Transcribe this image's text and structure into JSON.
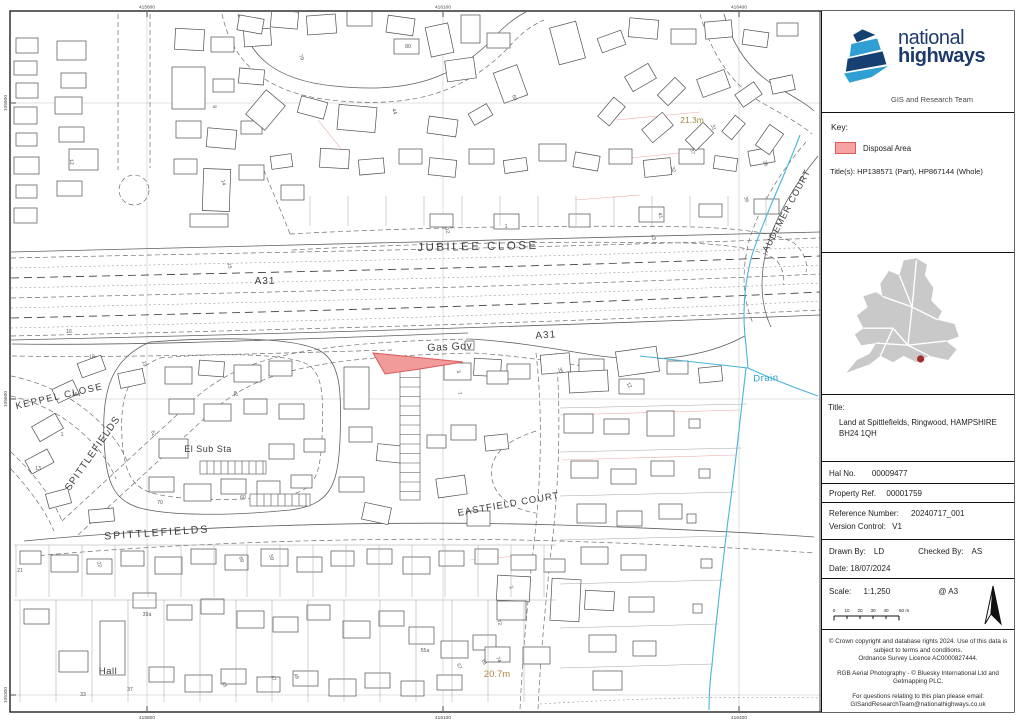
{
  "logo": {
    "line1": "national",
    "line2": "highways",
    "team": "GIS and Research Team"
  },
  "key": {
    "heading": "Key:",
    "disposal_label": "Disposal Area",
    "titles": "Title(s): HP138571 (Part), HP867144 (Whole)"
  },
  "title_block": {
    "label": "Title:",
    "line1": "Land at Spittlefields, Ringwood, HAMPSHIRE",
    "line2": "BH24 1QH"
  },
  "fields": {
    "hal_label": "Hal No.",
    "hal_value": "00009477",
    "property_label": "Property Ref.",
    "property_value": "00001759",
    "reference_label": "Reference Number:",
    "reference_value": "20240717_001",
    "version_label": "Version Control:",
    "version_value": "V1",
    "drawn_label": "Drawn By:",
    "drawn_value": "LD",
    "checked_label": "Checked By:",
    "checked_value": "AS",
    "date_label": "Date:",
    "date_value": "18/07/2024",
    "scale_label": "Scale:",
    "scale_value": "1:1,250",
    "scale_at": "@ A3"
  },
  "scalebar": {
    "ticks": [
      "0",
      "10",
      "20",
      "30",
      "40",
      "50 m"
    ]
  },
  "footer": {
    "para1": "© Crown copyright and database rights 2024. Use of this data is subject to terms and conditions.\nOrdnance Survey Licence AC0000827444.",
    "para2": "RGB Aerial Photography - © Bluesky International Ltd and Getmapping PLC.",
    "para3": "For questions relating to this plan please email:\nGISandResearchTeam@nationalhighways.co.uk"
  },
  "map": {
    "colors": {
      "disposal_fill": "#f29b9b",
      "disposal_stroke": "#d75b5b",
      "drain": "#49b4da",
      "spot_height": "#9a8b3e"
    },
    "street_labels": [
      {
        "t": "JUBILEE CLOSE",
        "x": 478,
        "y": 250,
        "s": 11.5,
        "r": -1,
        "ls": 2.5,
        "c": "#3d3d3d"
      },
      {
        "t": "A31",
        "x": 265,
        "y": 284,
        "s": 10,
        "r": 0,
        "ls": 1,
        "c": "#3d3d3d"
      },
      {
        "t": "A31",
        "x": 546,
        "y": 338,
        "s": 10,
        "r": -4,
        "ls": 1,
        "c": "#3d3d3d"
      },
      {
        "t": "Gas Gov",
        "x": 450,
        "y": 350,
        "s": 10.5,
        "r": -3,
        "ls": 0.5,
        "c": "#3d3d3d"
      },
      {
        "t": "KEPPEL  CLOSE",
        "x": 60,
        "y": 399,
        "s": 9.5,
        "r": -13,
        "ls": 1.5,
        "c": "#3d3d3d"
      },
      {
        "t": "SPITTLEFIELDS",
        "x": 95,
        "y": 455,
        "s": 10,
        "r": -55,
        "ls": 1,
        "c": "#3d3d3d"
      },
      {
        "t": "El Sub Sta",
        "x": 208,
        "y": 452,
        "s": 9,
        "r": 0,
        "ls": 0.5,
        "c": "#3d3d3d"
      },
      {
        "t": "SPITTLEFIELDS",
        "x": 157,
        "y": 536,
        "s": 10.5,
        "r": -4,
        "ls": 2,
        "c": "#3d3d3d"
      },
      {
        "t": "EASTFIELD COURT",
        "x": 509,
        "y": 507,
        "s": 9.5,
        "r": -10,
        "ls": 1,
        "c": "#3d3d3d"
      },
      {
        "t": "AUDEMER  COURT",
        "x": 789,
        "y": 212,
        "s": 9,
        "r": -62,
        "ls": 1,
        "c": "#3d3d3d"
      },
      {
        "t": "Drain",
        "x": 766,
        "y": 381,
        "s": 9.5,
        "r": -2,
        "ls": 0.5,
        "c": "#2f9ec6"
      },
      {
        "t": "21.3m",
        "x": 692,
        "y": 123,
        "s": 8.5,
        "r": 0,
        "ls": 0,
        "c": "#9a8b3e"
      },
      {
        "t": "20.7m",
        "x": 497,
        "y": 677,
        "s": 9.5,
        "r": 0,
        "ls": 0,
        "c": "#b08448"
      },
      {
        "t": "Hall",
        "x": 108,
        "y": 674,
        "s": 9.5,
        "r": 0,
        "ls": 0.5,
        "c": "#3d3d3d"
      }
    ],
    "house_numbers": [
      {
        "t": "12",
        "x": 70,
        "y": 162,
        "r": 85
      },
      {
        "t": "8",
        "x": 213,
        "y": 107,
        "r": 80
      },
      {
        "t": "14",
        "x": 222,
        "y": 183,
        "r": 75
      },
      {
        "t": "15",
        "x": 228,
        "y": 266,
        "r": 80
      },
      {
        "t": "16",
        "x": 69,
        "y": 333,
        "r": 0
      },
      {
        "t": "16a",
        "x": 76,
        "y": 396,
        "r": 0
      },
      {
        "t": "79",
        "x": 300,
        "y": 58,
        "r": 65
      },
      {
        "t": "80",
        "x": 408,
        "y": 48,
        "r": 0
      },
      {
        "t": "69",
        "x": 513,
        "y": 98,
        "r": 75
      },
      {
        "t": "44",
        "x": 393,
        "y": 112,
        "r": 70
      },
      {
        "t": "31",
        "x": 712,
        "y": 128,
        "r": 70
      },
      {
        "t": "37",
        "x": 691,
        "y": 152,
        "r": 72
      },
      {
        "t": "32",
        "x": 672,
        "y": 170,
        "r": 70
      },
      {
        "t": "26",
        "x": 764,
        "y": 164,
        "r": 68
      },
      {
        "t": "36",
        "x": 745,
        "y": 200,
        "r": 70
      },
      {
        "t": "12",
        "x": 446,
        "y": 231,
        "r": 75
      },
      {
        "t": "1",
        "x": 506,
        "y": 228,
        "r": 0
      },
      {
        "t": "41",
        "x": 659,
        "y": 216,
        "r": 70
      },
      {
        "t": "43",
        "x": 652,
        "y": 238,
        "r": 65
      },
      {
        "t": "3",
        "x": 457,
        "y": 372,
        "r": 75
      },
      {
        "t": "7",
        "x": 458,
        "y": 394,
        "r": 70
      },
      {
        "t": "35",
        "x": 559,
        "y": 371,
        "r": 70
      },
      {
        "t": "12",
        "x": 92,
        "y": 358,
        "r": -5
      },
      {
        "t": "19",
        "x": 143,
        "y": 364,
        "r": 75
      },
      {
        "t": "1",
        "x": 62,
        "y": 436,
        "r": 0
      },
      {
        "t": "13",
        "x": 38,
        "y": 470,
        "r": 0
      },
      {
        "t": "42",
        "x": 234,
        "y": 394,
        "r": 75
      },
      {
        "t": "62",
        "x": 152,
        "y": 434,
        "r": 70
      },
      {
        "t": "60",
        "x": 243,
        "y": 499,
        "r": 0
      },
      {
        "t": "70",
        "x": 160,
        "y": 504,
        "r": 0
      },
      {
        "t": "69",
        "x": 240,
        "y": 560,
        "r": 70
      },
      {
        "t": "59",
        "x": 270,
        "y": 558,
        "r": 70
      },
      {
        "t": "22",
        "x": 98,
        "y": 565,
        "r": 70
      },
      {
        "t": "21",
        "x": 20,
        "y": 572,
        "r": 0
      },
      {
        "t": "39a",
        "x": 147,
        "y": 616,
        "r": 0
      },
      {
        "t": "33",
        "x": 83,
        "y": 696,
        "r": 0
      },
      {
        "t": "37",
        "x": 130,
        "y": 691,
        "r": 0
      },
      {
        "t": "43",
        "x": 223,
        "y": 685,
        "r": 60
      },
      {
        "t": "47",
        "x": 272,
        "y": 679,
        "r": 60
      },
      {
        "t": "49",
        "x": 295,
        "y": 677,
        "r": 60
      },
      {
        "t": "55a",
        "x": 425,
        "y": 652,
        "r": 0
      },
      {
        "t": "57",
        "x": 458,
        "y": 667,
        "r": 60
      },
      {
        "t": "61",
        "x": 483,
        "y": 663,
        "r": 60
      },
      {
        "t": "72",
        "x": 498,
        "y": 623,
        "r": 70
      },
      {
        "t": "74",
        "x": 497,
        "y": 660,
        "r": 70
      },
      {
        "t": "2",
        "x": 510,
        "y": 588,
        "r": 60
      },
      {
        "t": "12",
        "x": 628,
        "y": 386,
        "r": 60
      }
    ],
    "grid": {
      "top": [
        "415800",
        "416100",
        "416400"
      ],
      "bottom": [
        "415800",
        "416100",
        "416400"
      ],
      "left": [
        "105900",
        "105600",
        "105300"
      ]
    }
  }
}
